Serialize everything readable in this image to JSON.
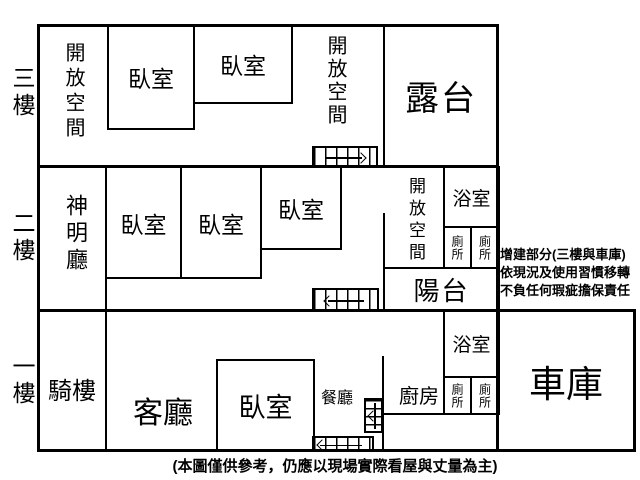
{
  "floors": {
    "f3": {
      "label": "三樓",
      "open_space_left": "開放空間",
      "bedroom1": "臥室",
      "bedroom2": "臥室",
      "open_space_right": "開放空間",
      "terrace": "露台"
    },
    "f2": {
      "label": "二樓",
      "shrine_hall": "神明廳",
      "bedroom1": "臥室",
      "bedroom2": "臥室",
      "bedroom3": "臥室",
      "open_space": "開放空間",
      "bathroom": "浴室",
      "toilet_left": "廁所",
      "toilet_right": "廁所",
      "balcony": "陽台"
    },
    "f1": {
      "label": "一樓",
      "arcade": "騎樓",
      "living_room": "客廳",
      "bedroom": "臥室",
      "dining_room": "餐廳",
      "kitchen": "廚房",
      "bathroom": "浴室",
      "toilet_left": "廁所",
      "toilet_right": "廁所",
      "garage": "車庫"
    }
  },
  "annotation": {
    "line1": "增建部分(三樓與車庫)",
    "line2": "依現況及使用習慣移轉",
    "line3": "不負任何瑕疵擔保責任"
  },
  "caption": "(本圖僅供參考，仍應以現場實際看屋與丈量為主)",
  "colors": {
    "wall": "#000000",
    "background": "#ffffff",
    "text": "#000000"
  }
}
